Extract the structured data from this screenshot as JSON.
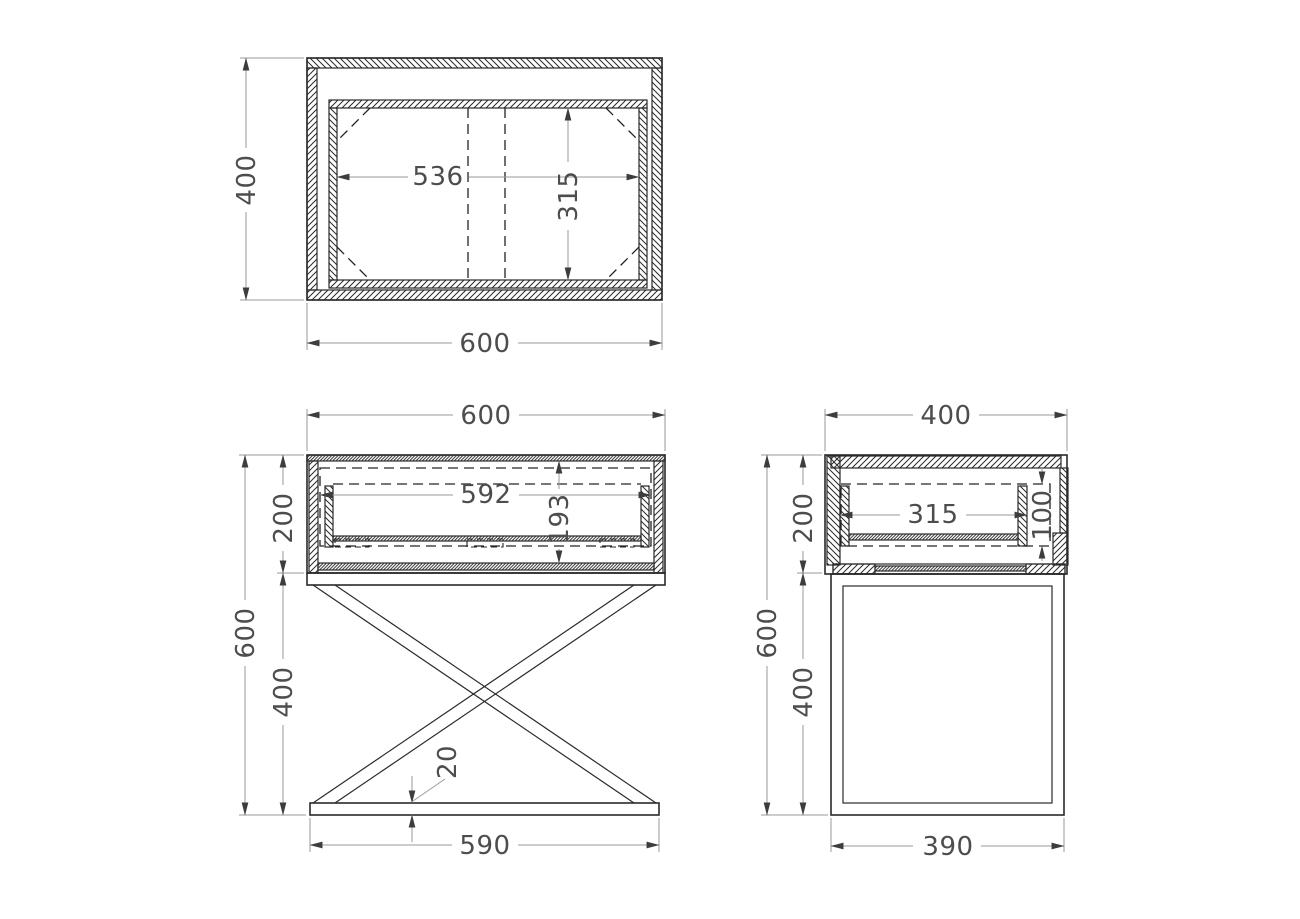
{
  "drawing_type": "furniture-orthographic-technical-drawing",
  "palette": {
    "background": "#ffffff",
    "object_line": "#2a2a2a",
    "dim_line": "#9a9a9a",
    "arrow": "#3d3d3d",
    "text": "#4d4d4d"
  },
  "views": {
    "top": {
      "overall_depth": "400",
      "overall_width": "600",
      "inner_width": "536",
      "inner_depth": "315"
    },
    "front": {
      "overall_width": "600",
      "carcass_height": "200",
      "drawer_width": "592",
      "drawer_height": "193",
      "total_height": "600",
      "legs_height": "400",
      "base_thickness": "20",
      "base_width": "590"
    },
    "side": {
      "overall_depth": "400",
      "carcass_height": "200",
      "drawer_depth": "315",
      "drawer_opening_height": "100",
      "total_height": "600",
      "legs_height": "400",
      "base_depth": "390"
    }
  }
}
